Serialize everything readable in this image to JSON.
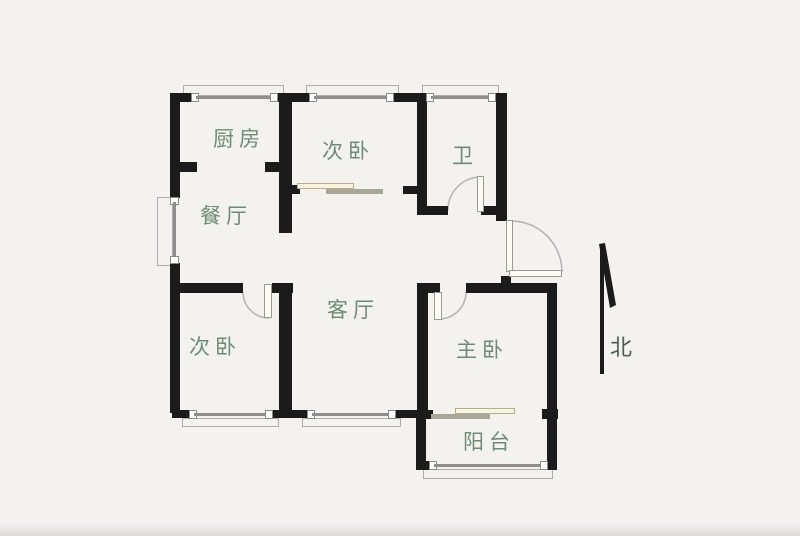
{
  "floor_plan": {
    "rooms": {
      "kitchen": {
        "label": "厨房"
      },
      "dining": {
        "label": "餐厅"
      },
      "bedroom_north": {
        "label": "次卧"
      },
      "bathroom": {
        "label": "卫"
      },
      "bedroom_west": {
        "label": "次卧"
      },
      "living": {
        "label": "客厅"
      },
      "master": {
        "label": "主卧"
      },
      "balcony": {
        "label": "阳台"
      }
    },
    "compass": {
      "label": "北"
    },
    "theme": {
      "wall": "#1b1b1b",
      "label": "#6f8a78",
      "compass_label": "#4f5d52",
      "arc": "#b3b3b3",
      "glass": "#8e8e8e",
      "frame": "#8a8a8a",
      "bay": "#adadad",
      "leaf_fill": "#fcfbf6",
      "leaf_border": "#9a9a92",
      "slide_border": "#b6b088",
      "slide_fill": "#f7f4e3",
      "slide_gray": "#a6a79a",
      "background": "#f3f2ef"
    }
  }
}
